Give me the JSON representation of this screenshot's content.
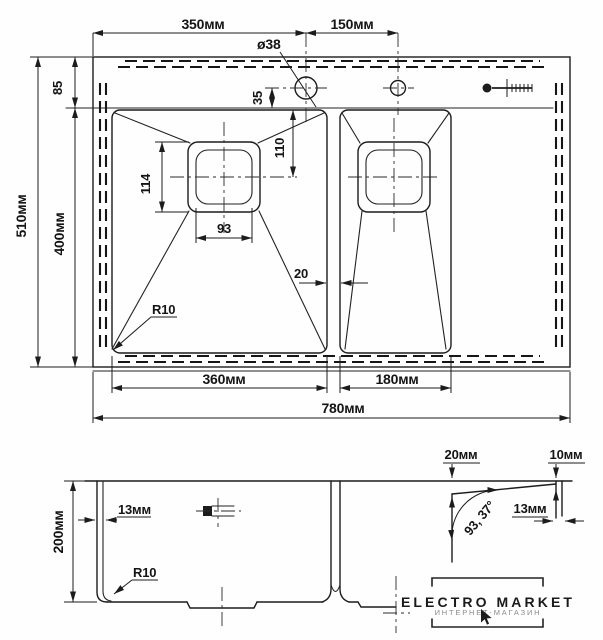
{
  "drawing": {
    "type": "sink-technical-drawing",
    "views": {
      "plan": "top view with two bowls",
      "section": "front section view"
    },
    "top_view": {
      "dims": {
        "d350": "350мм",
        "d150": "150мм",
        "hole_dia": "ø38",
        "d85": "85",
        "d35": "35",
        "d110": "110",
        "d114": "114",
        "d93": "93",
        "d20": "20",
        "r10": "R10",
        "d510": "510мм",
        "d400": "400мм",
        "d360": "360мм",
        "d180": "180мм",
        "d780": "780мм"
      }
    },
    "section_view": {
      "dims": {
        "d200": "200мм",
        "d13_wall": "13мм",
        "r10": "R10",
        "d20_rim": "20мм",
        "d10_edge": "10мм",
        "d13_edge": "13мм",
        "angle": "93, 37°"
      }
    },
    "watermark": {
      "title": "ELECTRO MARKET",
      "subtitle": "ИНТЕРНЕТ-МАГАЗИН"
    },
    "icons": {
      "screw": "mounting-screw",
      "clamp": "mounting-clamp",
      "cursor": "pointer-arrow"
    },
    "colors": {
      "line": "#1c1c1c",
      "background": "#ffffff",
      "watermark_sub": "#8a8a8a"
    }
  }
}
